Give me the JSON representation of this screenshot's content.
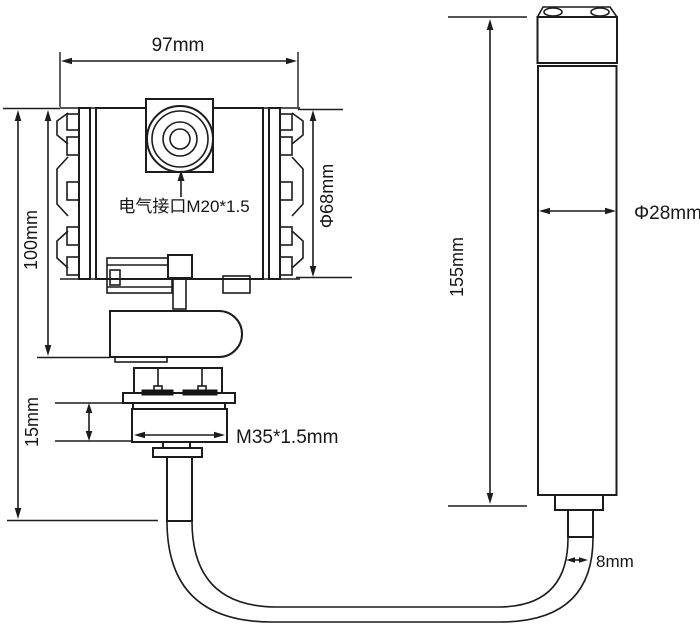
{
  "page": {
    "background_color": "#ffffff",
    "line_color": "#1c1c1c",
    "description_type": "engineering-dimension-drawing"
  },
  "diagram": {
    "transmitter": {
      "width_label": "97mm",
      "height_label": "100mm",
      "cap_diameter_label": "Φ68mm",
      "electrical_port_label": "电气接口M20*1.5",
      "thread_length_label": "15mm",
      "thread_spec_label": "M35*1.5mm"
    },
    "probe": {
      "length_label": "155mm",
      "diameter_label": "Φ28mm"
    },
    "cable": {
      "diameter_label": "8mm"
    }
  }
}
